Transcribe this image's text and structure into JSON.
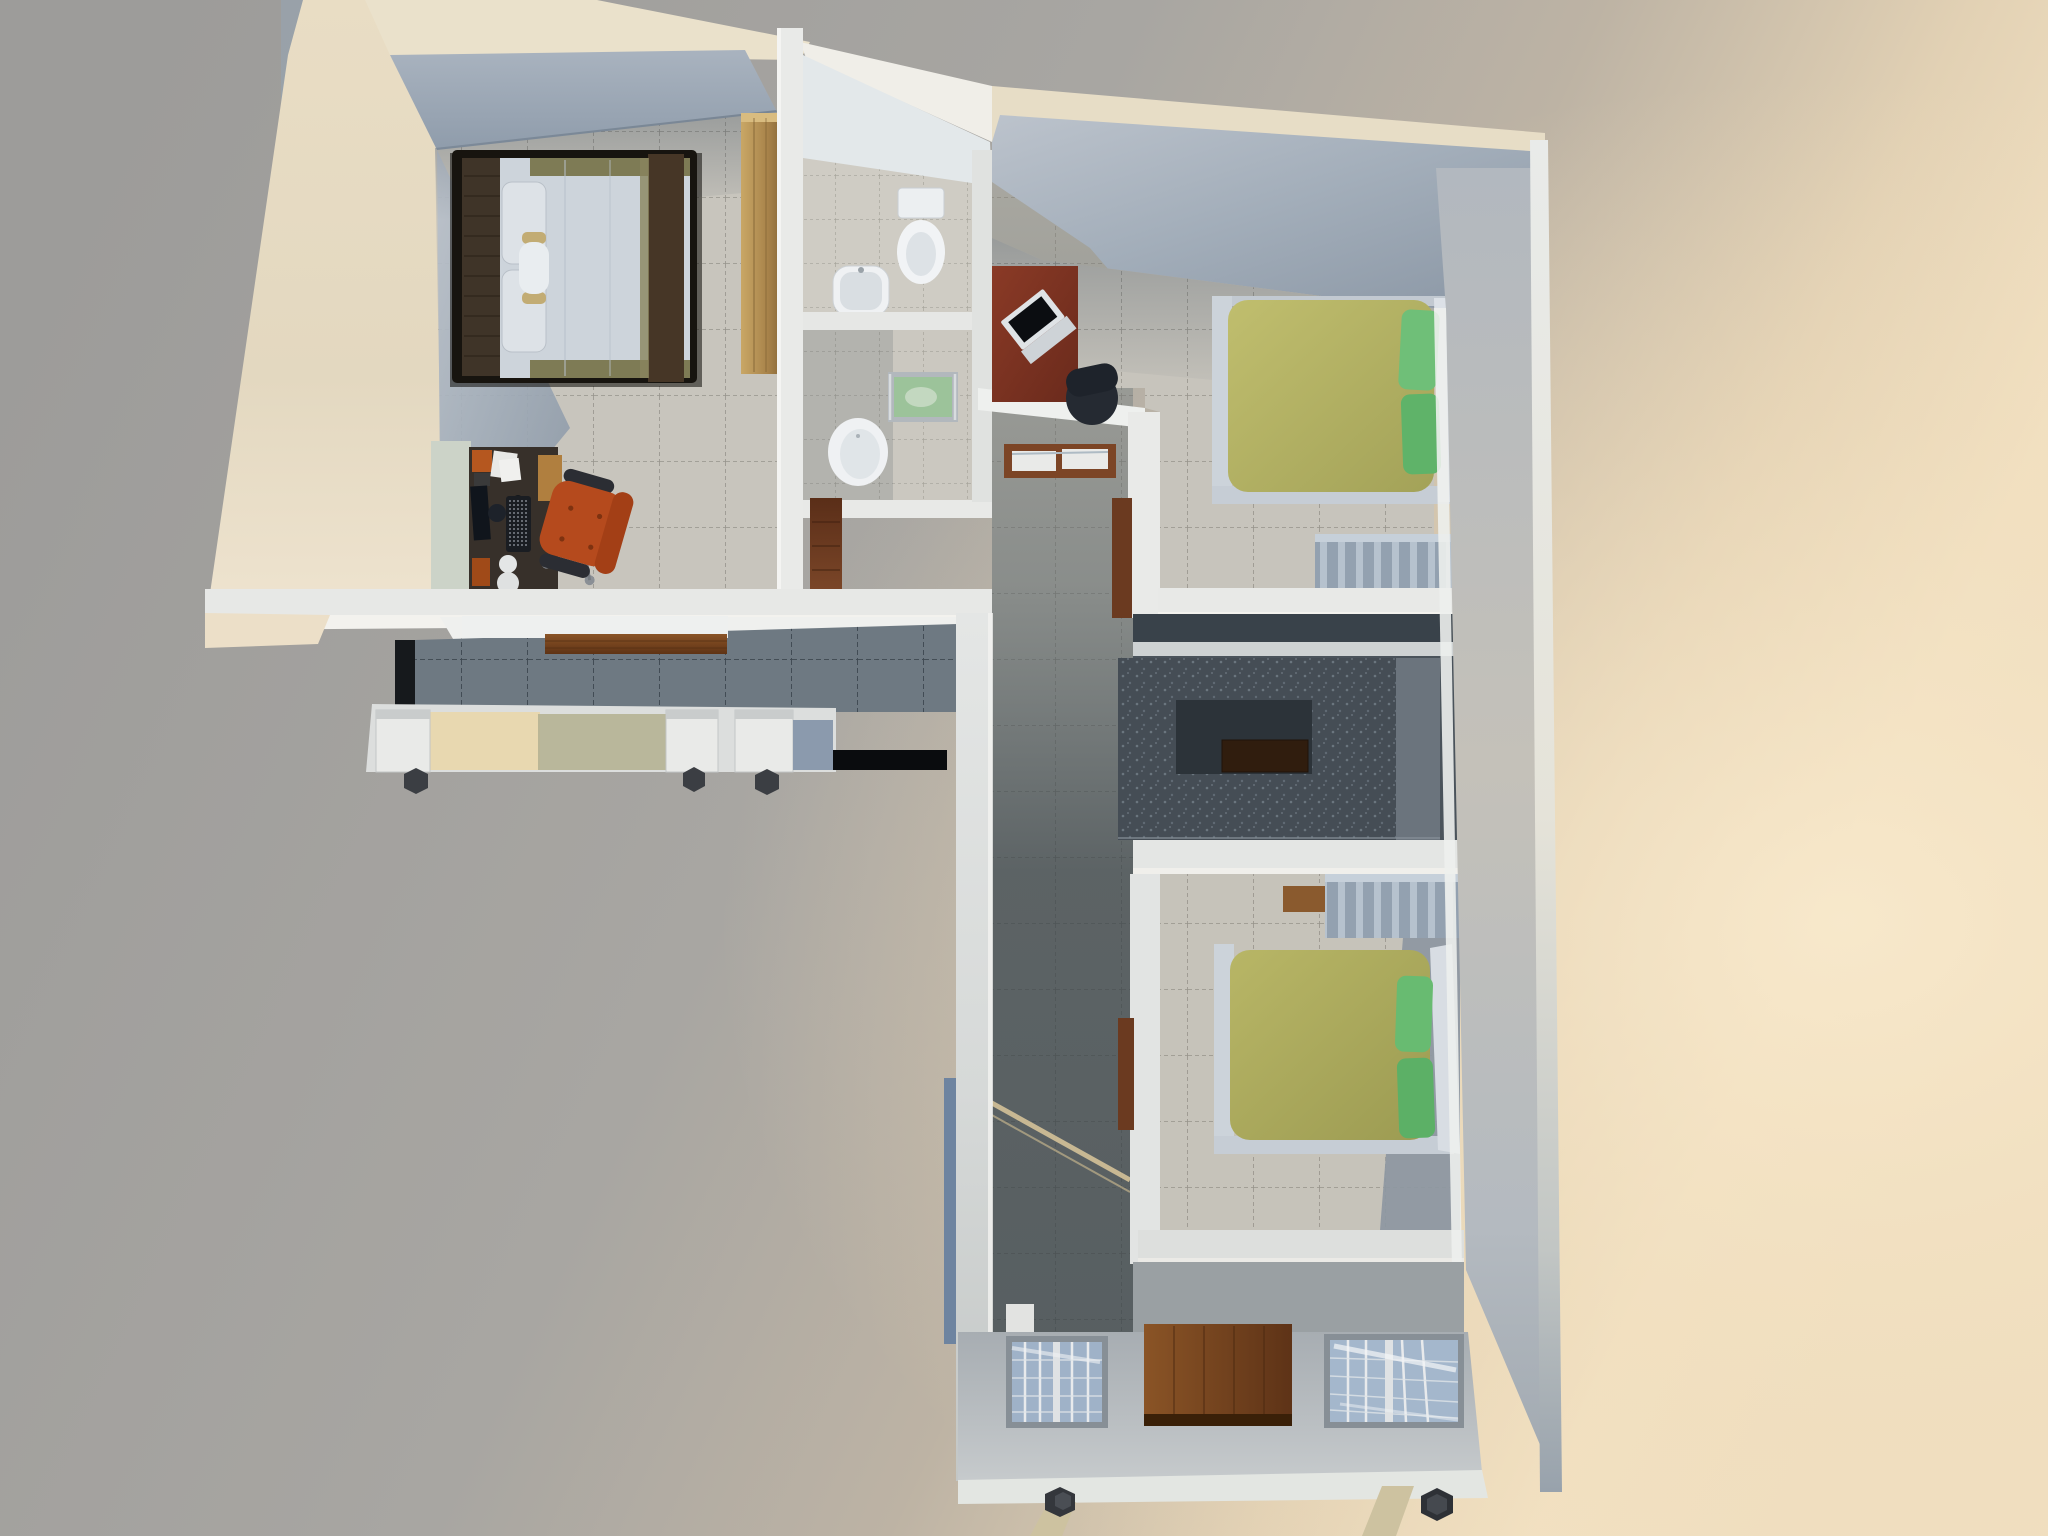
{
  "scene": {
    "description": "Top-down 3D architectural render of an L-shaped apartment model with warm light from the right",
    "view": "overhead perspective",
    "rooms": [
      {
        "id": "master-bedroom",
        "features": [
          "double-bed-dark-frame",
          "light-wood-wardrobe",
          "computer-desk",
          "orange-office-chair"
        ]
      },
      {
        "id": "bathroom-top",
        "features": [
          "toilet",
          "sink"
        ]
      },
      {
        "id": "bathroom-middle",
        "features": [
          "green-glass-vanity",
          "round-toilet",
          "dark-wood-door"
        ]
      },
      {
        "id": "bedroom-2",
        "features": [
          "green-double-bed",
          "red-laptop-desk",
          "dark-chair",
          "striped-sliding-wardrobe"
        ]
      },
      {
        "id": "kitchen",
        "features": [
          "u-shaped-granite-counter",
          "cooktop"
        ]
      },
      {
        "id": "bedroom-3",
        "features": [
          "green-double-bed",
          "striped-sliding-wardrobe",
          "wood-shelf"
        ]
      },
      {
        "id": "dining-room",
        "features": [
          "white-shelf",
          "wood-floor-strip",
          "three-open-window-boxes"
        ]
      },
      {
        "id": "hallway",
        "features": [
          "wall-console",
          "sunbeam-on-floor"
        ]
      },
      {
        "id": "facade",
        "features": [
          "entry-door",
          "two-grid-windows",
          "model-stand-legs"
        ]
      }
    ]
  },
  "palette": {
    "bg_gray": "#9d9c9a",
    "bg_warm": "#f6e5c6",
    "wall_cream": "#e3d8c0",
    "wall_cream_top": "#eae1cb",
    "wall_white": "#eef0ee",
    "wall_light": "#e7e8e6",
    "wall_lip": "#f3f2ee",
    "wall_face_blue": "#9aa6b4",
    "tile_light": "#c8c5bd",
    "tile_bath": "#cfccc4",
    "tile_corridor": "#a8a7a0",
    "tile_dining": "#6e7982",
    "kitchen_floor": "#4a535b",
    "counter": "#454d55",
    "counter_inner": "#2c3339",
    "cooktop": "#301d0e",
    "counter_light": "#6b747d",
    "wood_wardrobe": "#b08c52",
    "wood_floor": "#7a4a26",
    "wood_console": "#7c4526",
    "wood_door_dark": "#6b3a20",
    "desk_dark": "#37302a",
    "desk_red": "#7d3424",
    "cabinet_pale": "#ccd3c8",
    "side_table": "#b07f3f",
    "chair_orange": "#b54a1d",
    "chair_dark": "#252a32",
    "bed_frame_dark": "#17140f",
    "headboard": "#3f3428",
    "duvet_white": "#cdd4db",
    "pillow_white": "#dde2e7",
    "blanket_brown": "#463626",
    "olive_band": "#7e7b55",
    "bolster_cap": "#c2ac74",
    "duvet_green": "#b5b363",
    "duvet_green_2": "#b3b161",
    "pillow_green": "#6fbf78",
    "bed_rail_white": "#ccd3da",
    "sheet_white": "#dce1e7",
    "wardrobe_stripe_base": "#93a1b0",
    "porcelain": "#eff1f3",
    "vanity_green": "#9cc39a",
    "glass_blue": "#9fb2c8",
    "glass_blue_2": "#a4b7cc",
    "window_box": "#e9eae8",
    "window_glass_edge": "#8b9aad",
    "facade_wall": "#b3b9bd",
    "service_floor": "#9aa0a3",
    "leg_tan": "#cdc2a0",
    "foot_dark": "#34373c",
    "sunbeam": "#dcc89c",
    "shelf_white": "#eef0ef",
    "console_opening": "#e9eae8",
    "dark_gap": "#0a0c0e"
  }
}
